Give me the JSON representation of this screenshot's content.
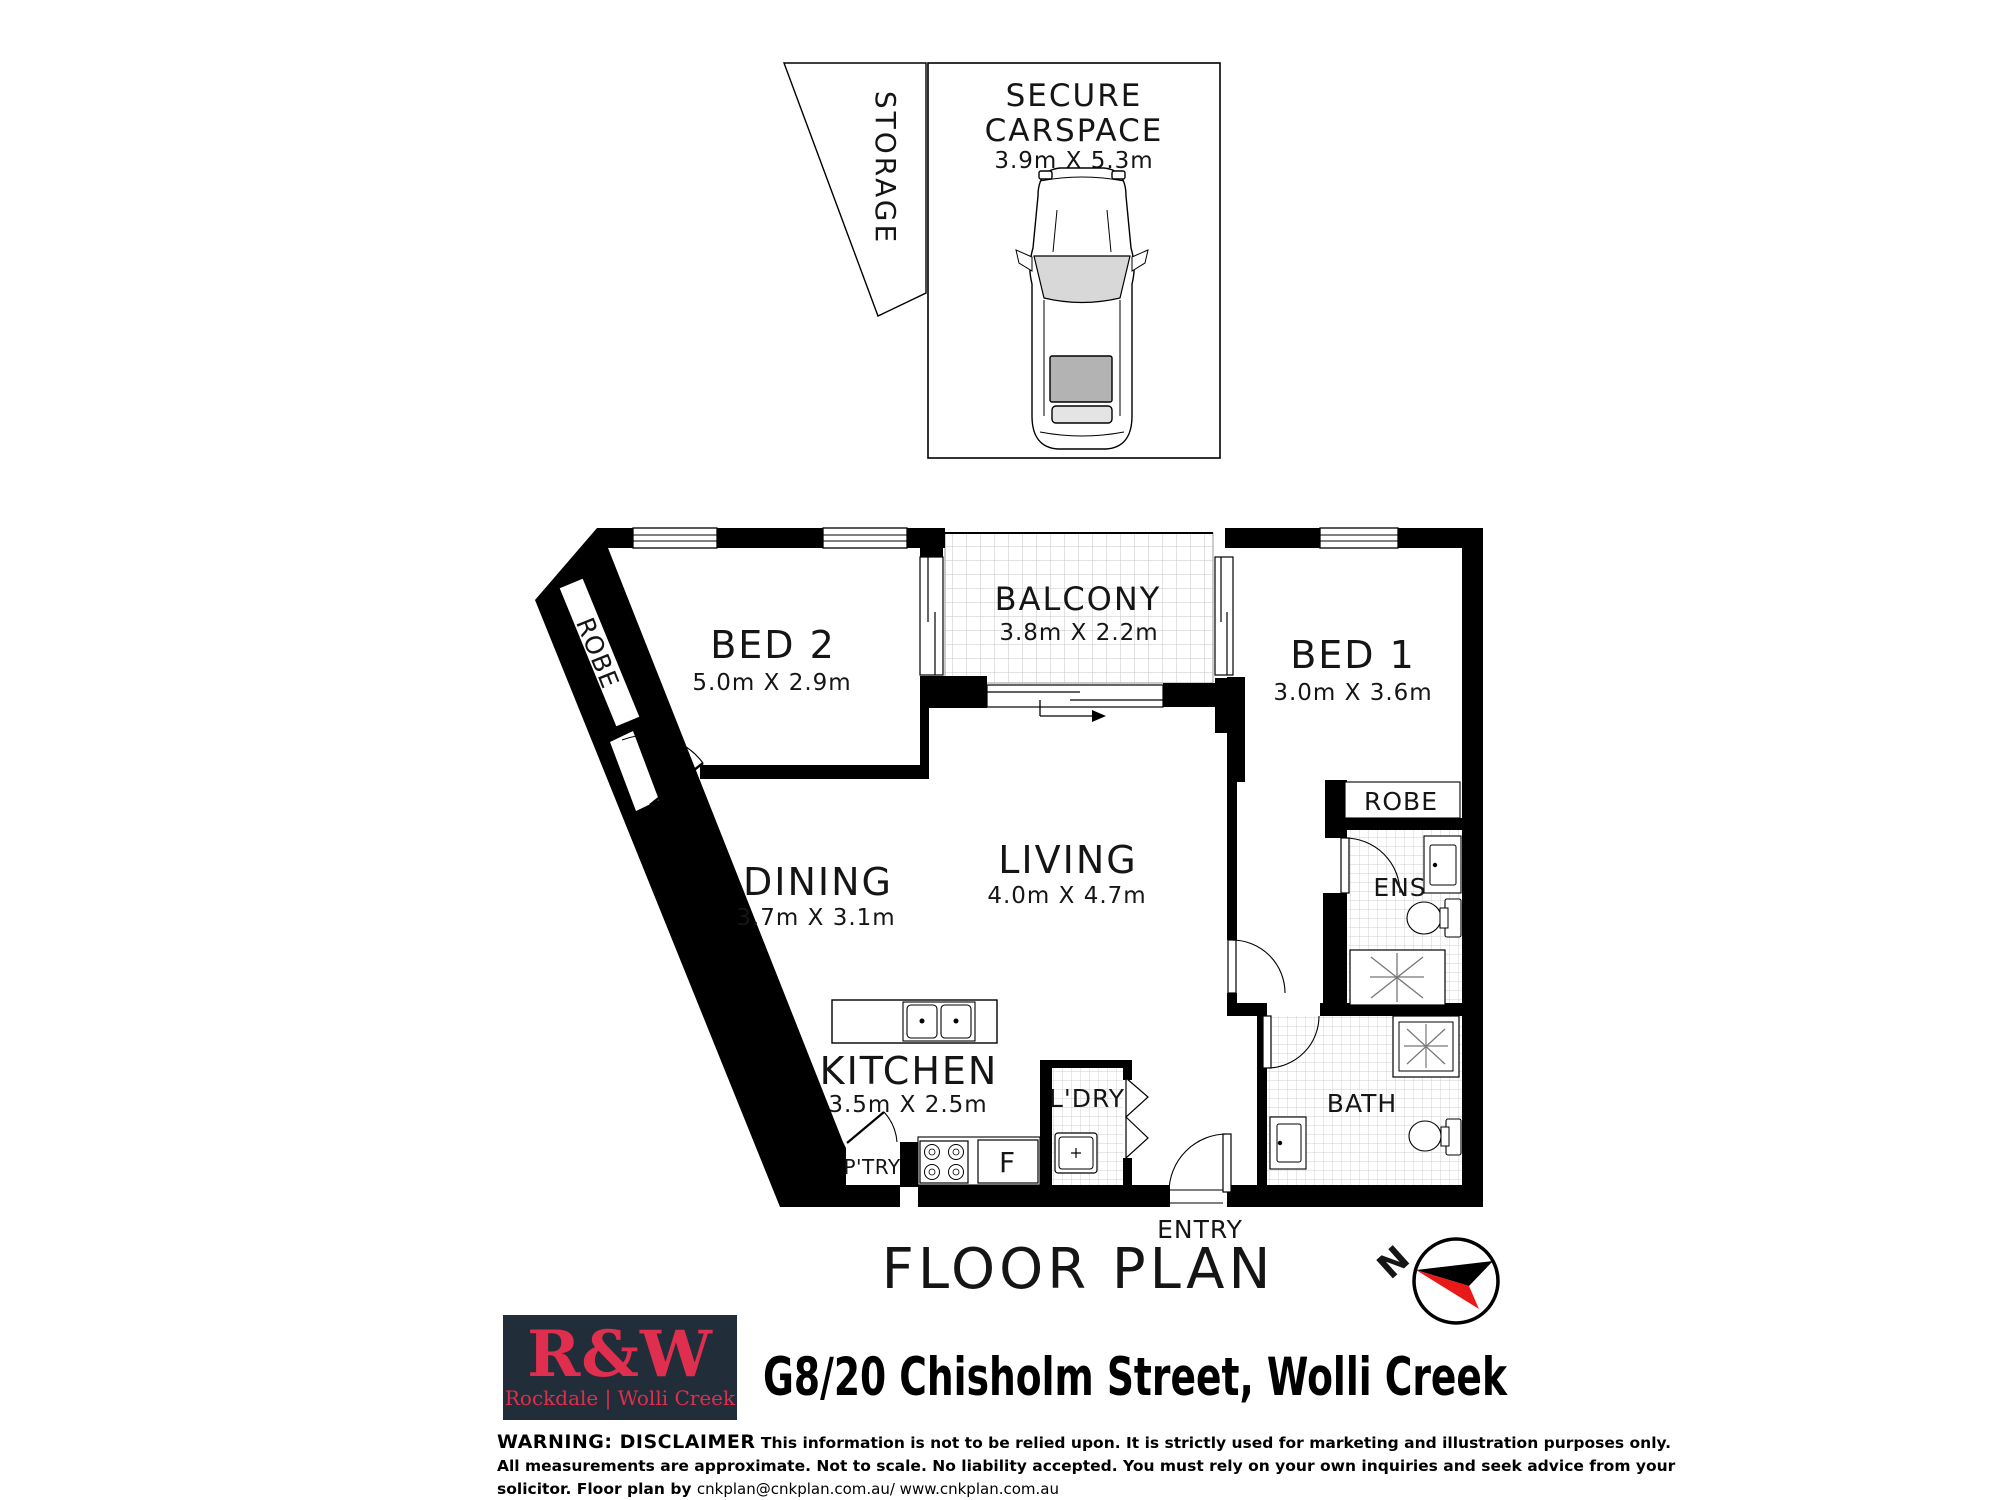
{
  "storage": {
    "label": "STORAGE"
  },
  "carspace": {
    "line1": "SECURE",
    "line2": "CARSPACE",
    "dims": "3.9m X 5.3m"
  },
  "rooms": {
    "bed2": {
      "label": "BED 2",
      "dims": "5.0m X 2.9m"
    },
    "balcony": {
      "label": "BALCONY",
      "dims": "3.8m X 2.2m"
    },
    "bed1": {
      "label": "BED 1",
      "dims": "3.0m X 3.6m"
    },
    "dining": {
      "label": "DINING",
      "dims": "3.7m X 3.1m"
    },
    "living": {
      "label": "LIVING",
      "dims": "4.0m X 4.7m"
    },
    "kitchen": {
      "label": "KITCHEN",
      "dims": "3.5m X 2.5m"
    },
    "laundry": {
      "label": "L'DRY"
    },
    "bath": {
      "label": "BATH"
    },
    "ens": {
      "label": "ENS"
    },
    "robe_bed1": {
      "label": "ROBE"
    },
    "robe_bed2": {
      "label": "ROBE"
    },
    "pantry": {
      "label": "P'TRY"
    },
    "fridge": {
      "label": "F"
    },
    "entry": {
      "label": "ENTRY"
    }
  },
  "title": "FLOOR PLAN",
  "compass": {
    "north_label": "N",
    "black": "#000000",
    "red": "#e81919"
  },
  "branding": {
    "logo_main": "R&W",
    "logo_sub": "Rockdale | Wolli Creek",
    "logo_bg": "#222d3a",
    "logo_red": "#e02e4e"
  },
  "address": "G8/20 Chisholm Street, Wolli Creek",
  "disclaimer": {
    "warning": "WARNING: DISCLAIMER",
    "line1": "This information is not to be relied upon. It is strictly used for marketing and illustration purposes only.",
    "line2": "All measurements are approximate. Not to scale. No liability accepted. You must rely on your own inquiries and seek advice from your",
    "line3_prefix": "solicitor. Floor plan by ",
    "line3_contact": "cnkplan@cnkplan.com.au/ www.cnkplan.com.au"
  },
  "colors": {
    "wall": "#000000",
    "tile_fine": "#d0d0d0",
    "tile_coarse": "#c4c4c4"
  }
}
